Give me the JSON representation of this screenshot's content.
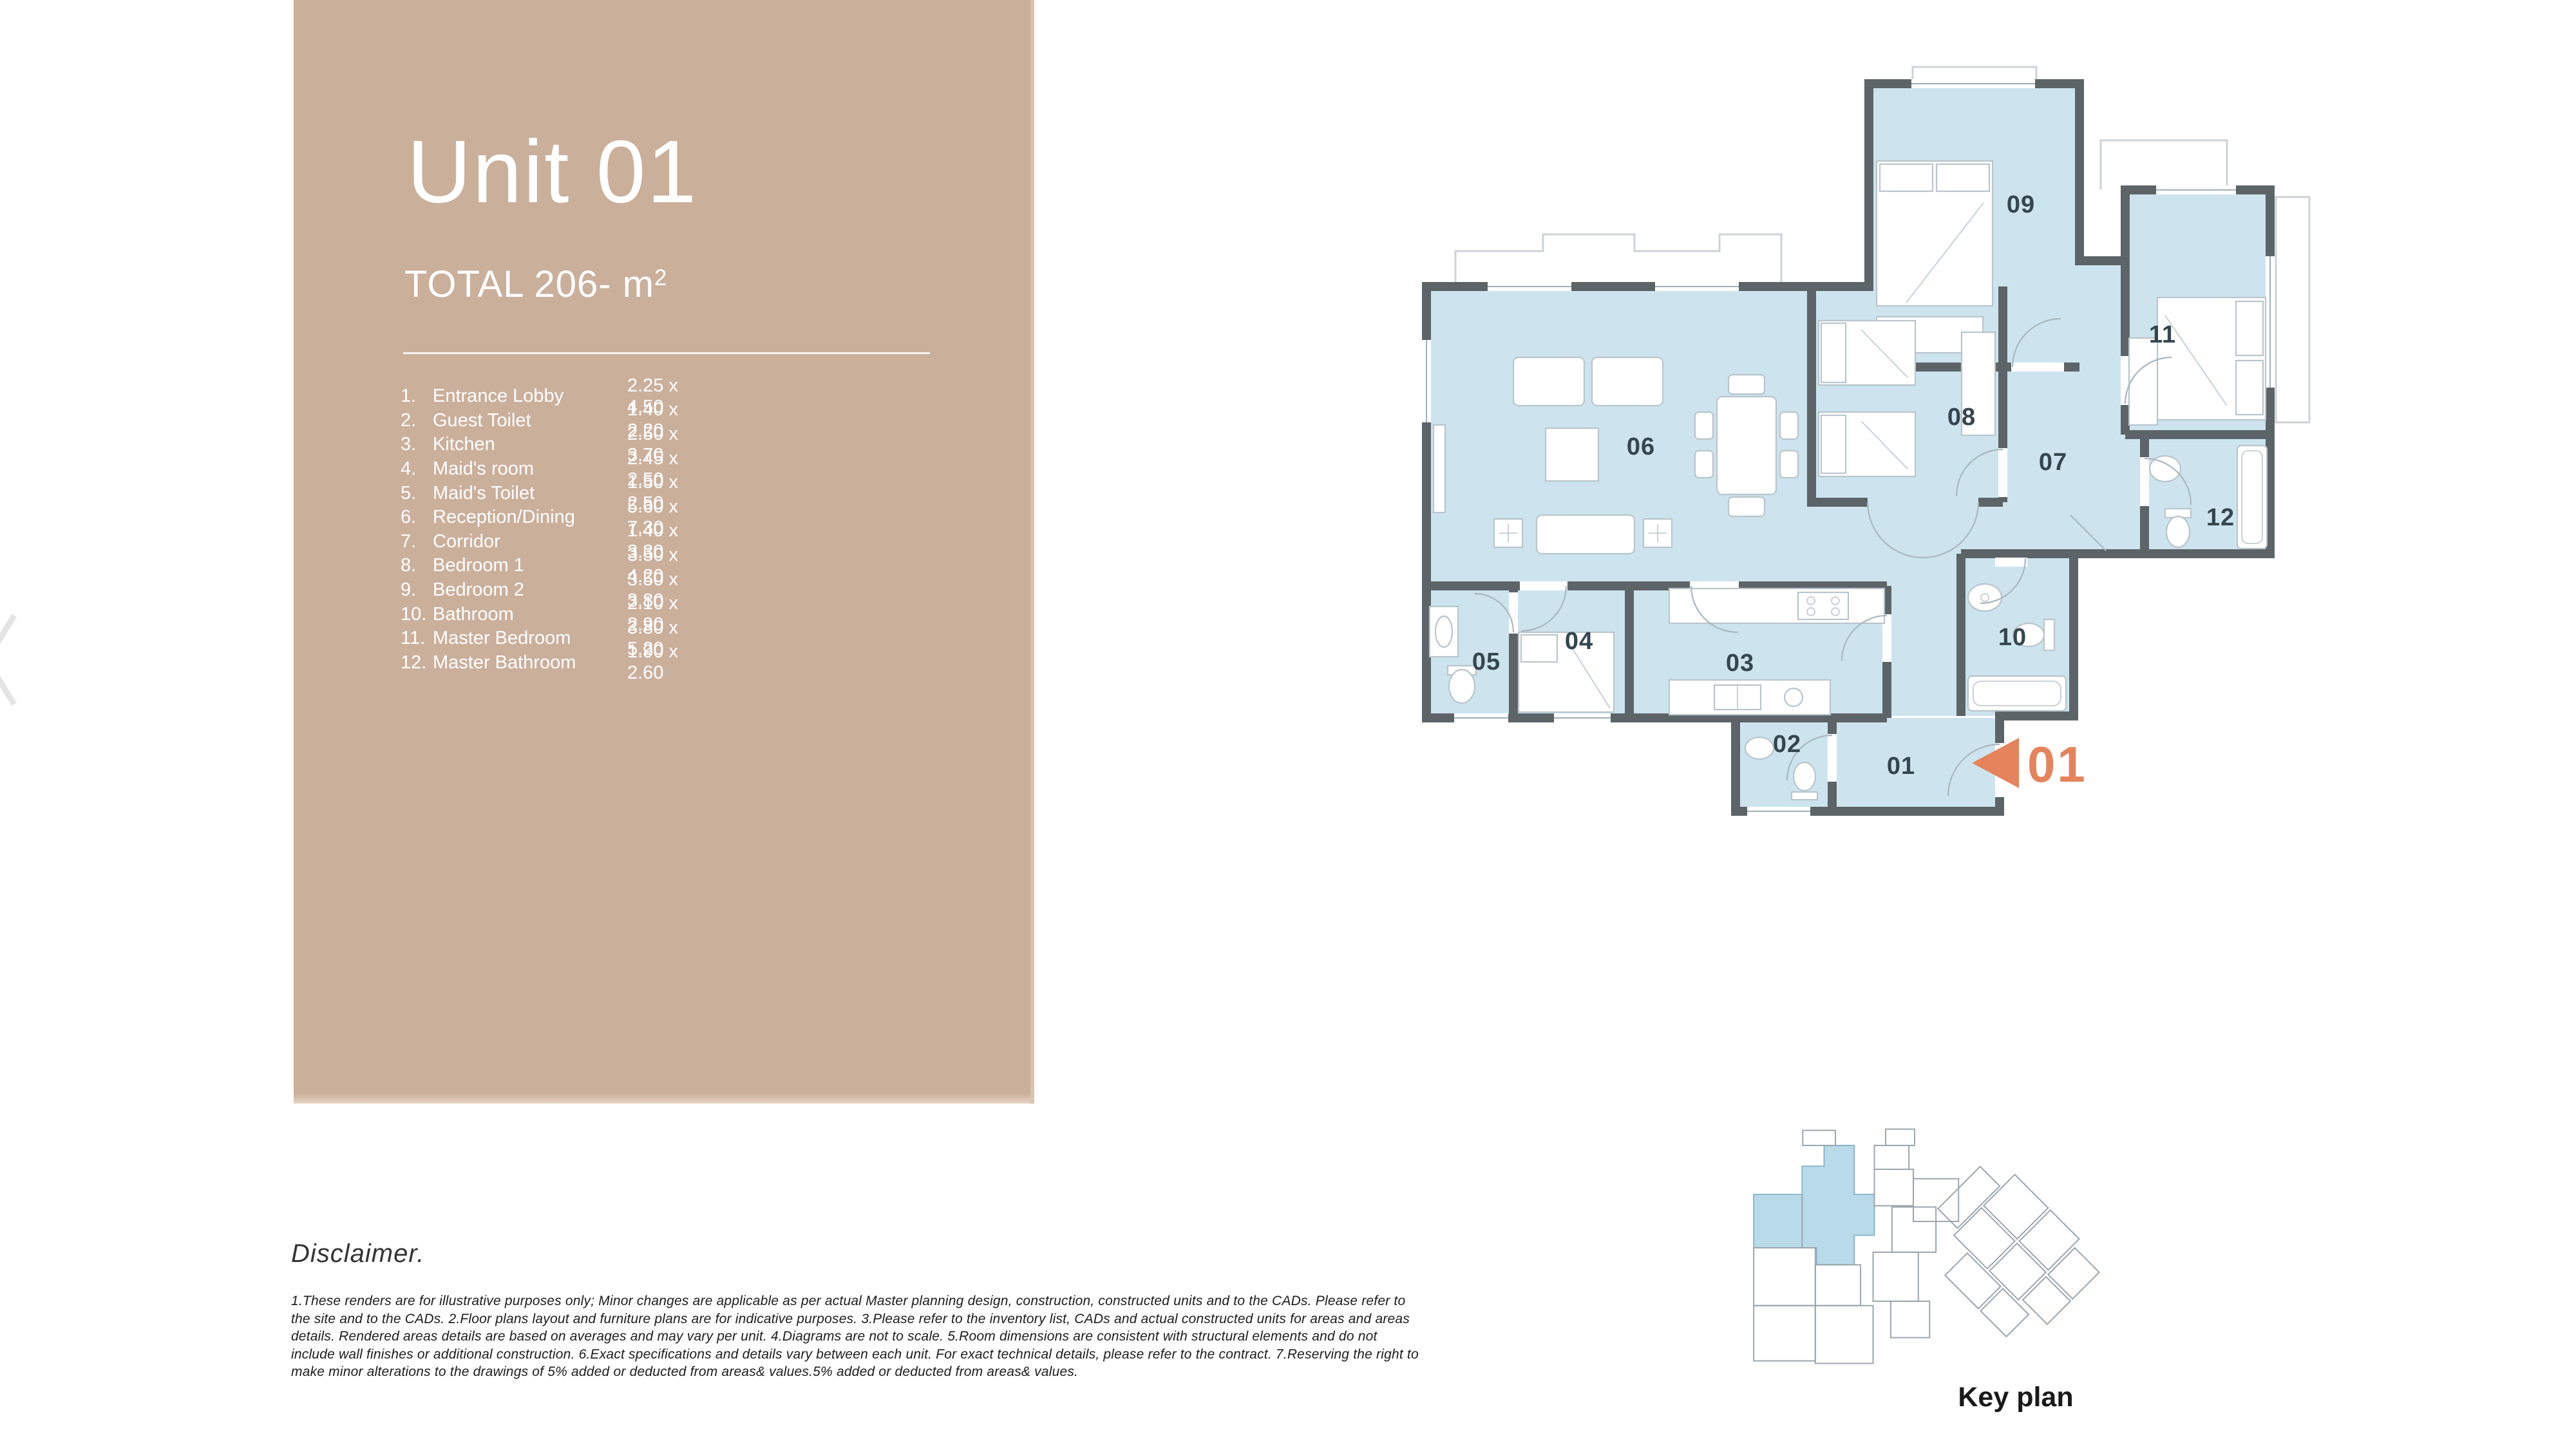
{
  "panel": {
    "title": "Unit 01",
    "total_prefix": "TOTAL 206- m",
    "total_exponent": "2",
    "rooms": [
      {
        "num": "1.",
        "name": "Entrance Lobby",
        "dims": "2.25 x 4.50"
      },
      {
        "num": "2.",
        "name": "Guest Toilet",
        "dims": "1.40 x 2.20"
      },
      {
        "num": "3.",
        "name": "Kitchen",
        "dims": "2.50 x 3.70"
      },
      {
        "num": "4.",
        "name": "Maid's room",
        "dims": "2.45 x 2.50"
      },
      {
        "num": "5.",
        "name": "Maid's Toilet",
        "dims": "1.50 x 2.50"
      },
      {
        "num": "6.",
        "name": "Reception/Dining",
        "dims": "5.60 x 7.30"
      },
      {
        "num": "7.",
        "name": "Corridor",
        "dims": "1.40 x 3.30"
      },
      {
        "num": "8.",
        "name": "Bedroom 1",
        "dims": "3.50 x 4.20"
      },
      {
        "num": "9.",
        "name": "Bedroom 2",
        "dims": "3.50 x 3.80"
      },
      {
        "num": "10.",
        "name": "Bathroom",
        "dims": "2.10 x 2.90"
      },
      {
        "num": "11.",
        "name": "Master Bedroom",
        "dims": "3.80 x 5.20"
      },
      {
        "num": "12.",
        "name": "Master Bathroom",
        "dims": "1.90 x 2.60"
      }
    ]
  },
  "floor_plan": {
    "labels": [
      "01",
      "02",
      "03",
      "04",
      "05",
      "06",
      "07",
      "08",
      "09",
      "10",
      "11",
      "12"
    ],
    "entrance_marker": "01"
  },
  "disclaimer": {
    "heading": "Disclaimer.",
    "lines": [
      "1.These renders are for illustrative purposes only; Minor changes are applicable as per actual Master planning design, construction, constructed units and to the CADs. Please refer to",
      "the site and to the CADs. 2.Floor plans layout and furniture plans are for indicative purposes. 3.Please refer to the inventory list, CADs and actual constructed units for areas and areas",
      "details. Rendered areas details are based on averages and may vary per unit. 4.Diagrams are not to scale. 5.Room dimensions are consistent with structural elements and do not",
      "include wall finishes or additional construction. 6.Exact specifications and details vary between each unit. For exact technical details, please refer to the contract. 7.Reserving the right to",
      "make minor alterations to the drawings of 5% added or deducted from areas& values.5% added or deducted from areas& values."
    ]
  },
  "key_plan": {
    "label": "Key plan"
  },
  "colors": {
    "panel_tan": "#CAAF9B",
    "room_blue": "#CDE4EE",
    "wall_gray": "#5C6468",
    "accent_orange": "#E5845C",
    "label_slate": "#35464F"
  }
}
